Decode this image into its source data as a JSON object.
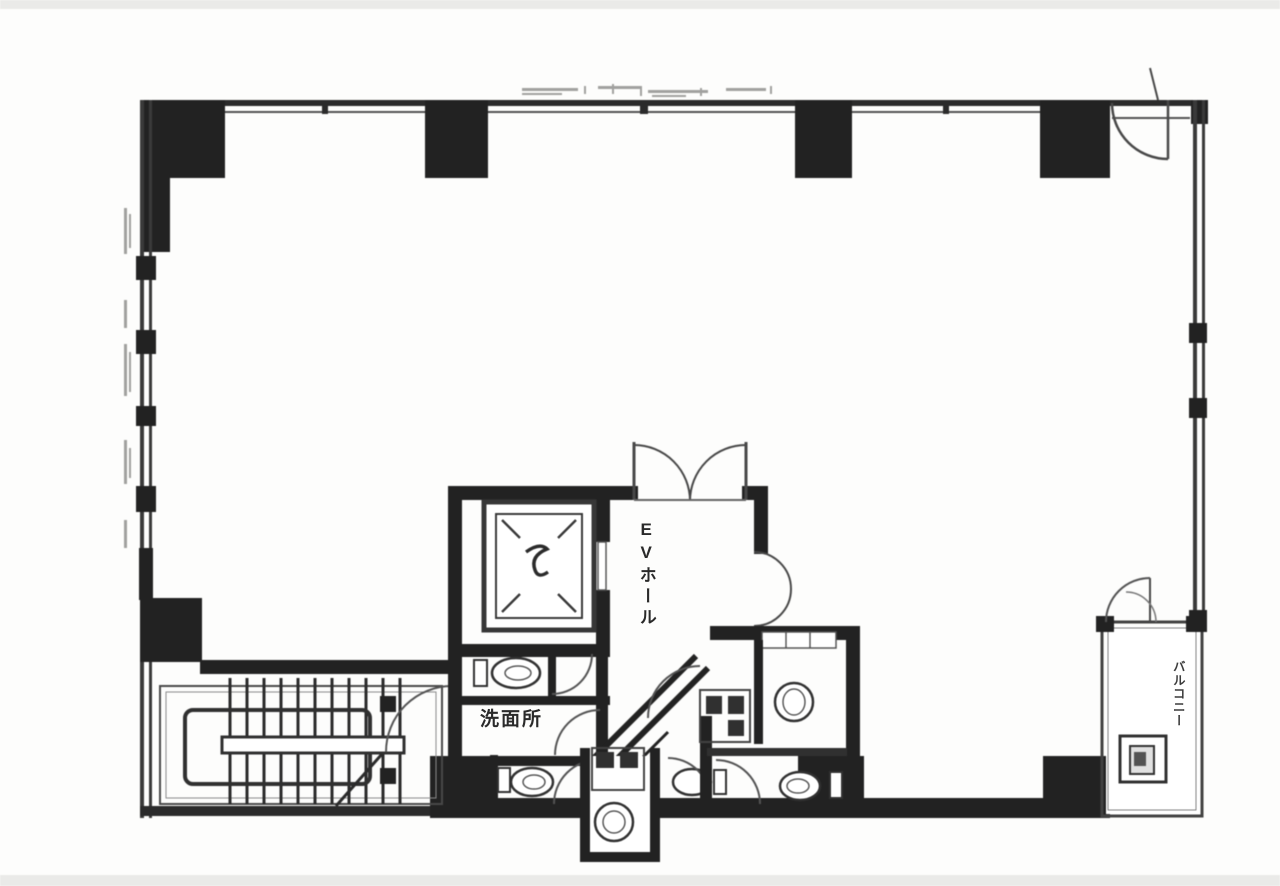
{
  "floorplan": {
    "labels": {
      "ev_hall": "EVホール",
      "washroom": "洗面所",
      "balcony": "バルコニー"
    },
    "colors": {
      "paper": "#fdfdfc",
      "ink": "#262626",
      "line": "#3d3d3d",
      "thin_line": "#6f6f6f",
      "annotation": "#a0a09e",
      "scan_edge": "#e6e6e4"
    },
    "features": [
      "elevator-car",
      "elevator-hall-double-doors",
      "u-shaped-staircase",
      "toilet-fixtures",
      "sink-basins",
      "balcony-unit",
      "perimeter-window-walls"
    ]
  }
}
